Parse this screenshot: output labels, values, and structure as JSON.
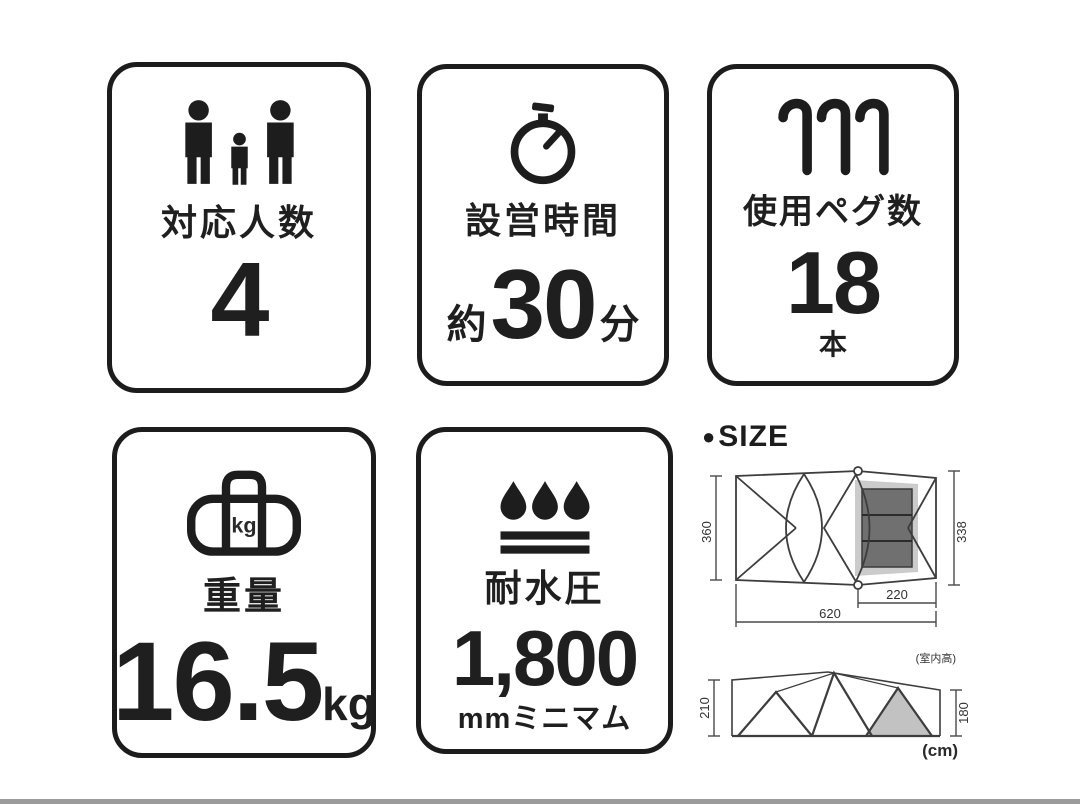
{
  "cards": [
    {
      "id": "capacity",
      "icon": "people-icon",
      "label": "対応人数",
      "value": "4"
    },
    {
      "id": "setup-time",
      "icon": "stopwatch-icon",
      "label": "設営時間",
      "value_prefix": "約",
      "value": "30",
      "value_suffix": "分"
    },
    {
      "id": "pegs",
      "icon": "pegs-icon",
      "label": "使用ペグ数",
      "value": "18",
      "unit": "本"
    },
    {
      "id": "weight",
      "icon": "duffel-bag-icon",
      "icon_text": "kg",
      "label": "重量",
      "value": "16.5",
      "unit": "kg"
    },
    {
      "id": "water-pressure",
      "icon": "water-drops-icon",
      "label": "耐水圧",
      "value": "1,800",
      "unit": "mmミニマム"
    }
  ],
  "size_section": {
    "bullet": "●",
    "title": "SIZE",
    "top_view": {
      "dim_left": "360",
      "dim_right": "338",
      "dim_inner_width": "220",
      "dim_total_width": "620"
    },
    "side_view": {
      "dim_left": "210",
      "dim_right": "180",
      "note_inner_height": "(室内高)",
      "unit_note": "(cm)"
    }
  },
  "colors": {
    "card_border": "#1c1c1c",
    "diagram_line": "#3d3d3d",
    "room_dark": "#707070",
    "room_light": "#cbcbcb",
    "bottom_bar": "#9b9b9b"
  }
}
